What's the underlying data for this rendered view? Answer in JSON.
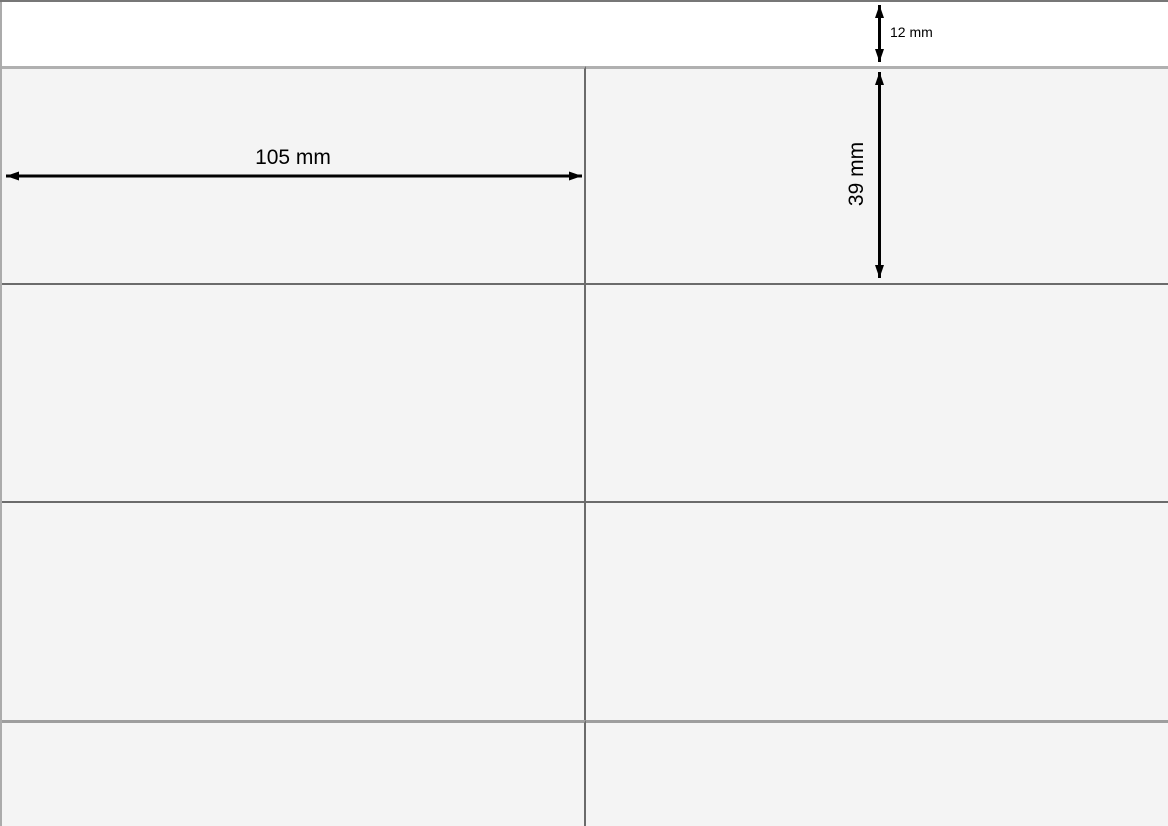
{
  "diagram": {
    "type": "label-sheet-dimension-diagram",
    "dimensions": {
      "top_margin_label": "12 mm",
      "label_width_label": "105 mm",
      "label_height_label": "39 mm",
      "top_margin_mm": 12,
      "label_width_mm": 105,
      "label_height_mm": 39
    },
    "grid": {
      "columns": 2,
      "visible_rows": 4
    },
    "colors": {
      "sheet_background": "#ffffff",
      "cell_background": "#f4f4f4",
      "grid_line_dark": "#6b6b6b",
      "grid_line_light": "#b0b0b0",
      "grid_line_medium": "#9e9e9e",
      "page_edge_top": "#777777",
      "page_edge_left": "#ababab",
      "dimension_arrow": "#000000",
      "dimension_text": "#000000"
    }
  }
}
